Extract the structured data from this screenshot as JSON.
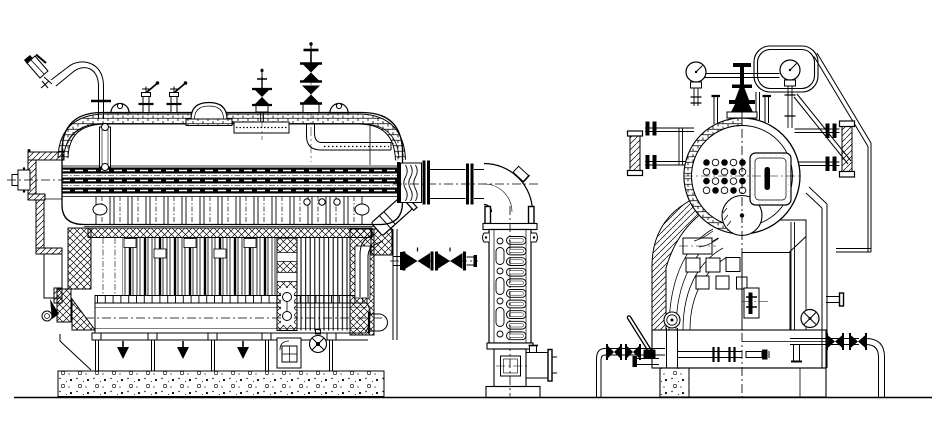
{
  "page": {
    "background": "#ffffff",
    "line_color": "#000000"
  },
  "drawing": {
    "kind": "technical line drawing",
    "subject": "industrial steam boiler general arrangement",
    "views": {
      "side": {
        "label": "Boiler side elevation (sectioned)"
      },
      "end": {
        "label": "Boiler end elevation (half-sectioned)"
      }
    },
    "components": {
      "steam_drum": "Steam drum",
      "drum_end": "Steam drum end (half section)",
      "drum_fittings": "Drum-top valves and fittings",
      "fire_tube_bundle": "Fire tube bundle",
      "water_tubes": "Convection tube bank",
      "furnace": "Furnace enclosure",
      "lower_drum": "Lower drum",
      "foundation": "Concrete foundation",
      "front_casing": "Front smokebox casing",
      "main_steam_valve": "Main steam stop valve",
      "feed_valve": "Feed check valve",
      "safety_valve": "Safety valve and gauge stand",
      "pressure_gauges": "Pressure gauges",
      "water_gauge": "Water level gauge",
      "lifting_lugs": "Lifting lugs",
      "manhole": "Manhole cover",
      "steam_outlet": "Steam outlet with expansion joint",
      "flue_elbow": "Flue gas elbow",
      "economizer": "Economizer / flue column",
      "blowdown": "Blow-down piping and valves",
      "blowoff_valve": "Blow-off valve",
      "handrail": "Platform handrail",
      "supports": "Support legs and drain funnels",
      "drain_funnels": "Drain funnels",
      "access_door": "Access door",
      "handwheel_valve": "Handwheel valve",
      "soot_blower": "Burner / soot-blower fitting",
      "sample_pipe": "Sampling pipe",
      "rear_casing": "Boiler casing (end view)",
      "ground": "Ground line"
    }
  }
}
